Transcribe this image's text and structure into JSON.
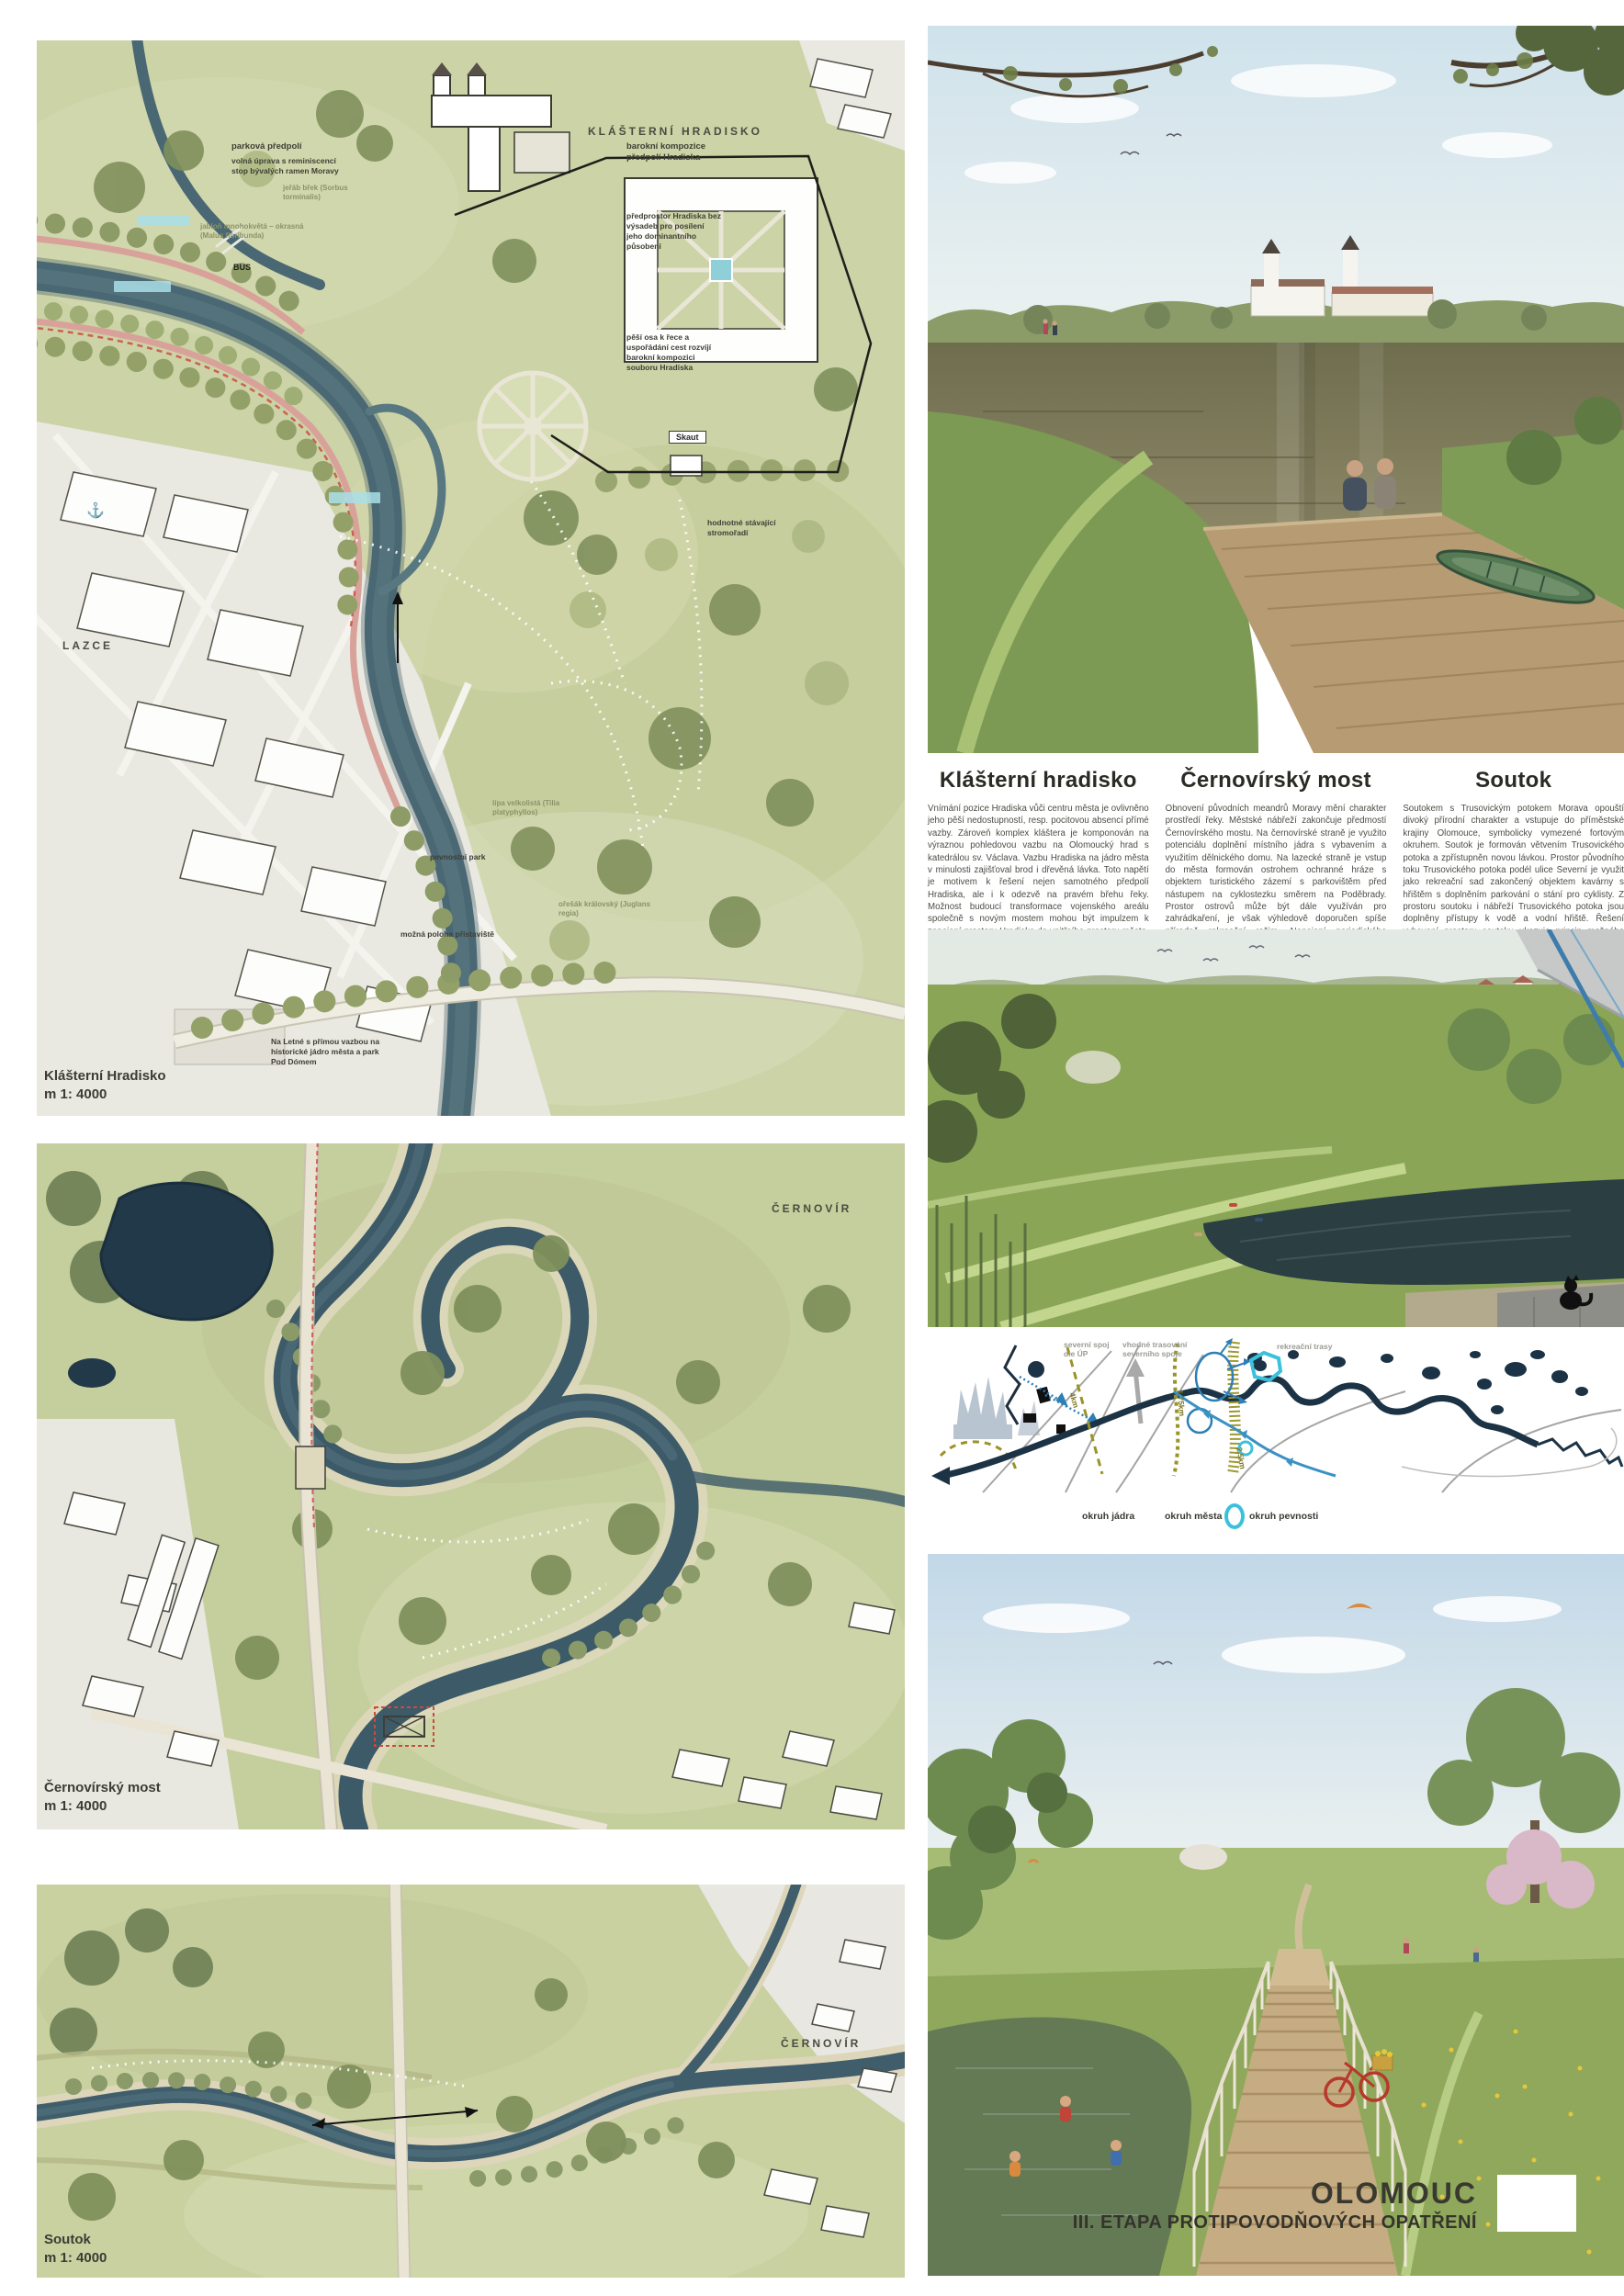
{
  "title_block": {
    "city": "OLOMOUC",
    "subtitle": "III. ETAPA PROTIPOVODŇOVÝCH OPATŘENÍ"
  },
  "articles": [
    {
      "heading": "Klášterní hradisko",
      "body": "Vnímání pozice Hradiska vůči centru města je ovlivněno jeho pěší nedostupností, resp. pocitovou absencí přímé vazby. Zároveň komplex kláštera je komponován na výraznou pohledovou vazbu na Olomoucký hrad s katedrálou sv. Václava. Vazbu Hradiska na jádro města v minulosti zajišťoval brod i dřevěná lávka. Toto napětí je motivem k řešení nejen samotného předpolí Hradiska, ale i k odezvě na pravém břehu řeky. Možnost budoucí transformace vojenského areálu společně s novým mostem mohou být impulzem k zapojení prostoru Hradiska do vnitřního prostoru města. Předpolí Hradiska přibližuje k městu nový ostrov na ose kláštera, přístupný brodem. Volné plochy po stranách Hradiska jsou upraveny na povodňový park. Sokolovská je jižně od Hradiska zklidněna pro posílení vazby na nábřeží."
    },
    {
      "heading": "Černovírský most",
      "body": "Obnovení původních meandrů Moravy mění charakter prostředí řeky. Městské nábřeží zakončuje předmostí Černovírského mostu. Na černovírské straně je využito potenciálu doplnění místního jádra s vybavením a využitím dělnického domu. Na lazecké straně je vstup do města formován ostrohem ochranné hráze s objektem turistického zázemí s parkovištěm před nástupem na cyklostezku směrem na Poděbrady. Prostor ostrovů může být dále využíván pro zahrádkaření, je však výhledově doporučen spíše přírodně rekreační režim. Napojení periodického ramene předpokládá rozšíření Černovírského mostu, není však podmínkou úpravy hlavního koryta."
    },
    {
      "heading": "Soutok",
      "body": "Soutokem s Trusovickým potokem Morava opouští divoký přírodní charakter a vstupuje do příměstské krajiny Olomouce, symbolicky vymezené fortovým okruhem. Soutok je formován větvením Trusovického potoka a zpřístupněn novou lávkou. Prostor původního toku Trusovického potoka podél ulice Severní je využit jako rekreační sad zakončený objektem kavárny s hřištěm s doplněním parkování o stání pro cyklisty. Z prostoru soutoku i nábřeží Trusovického potoka jsou doplněny přístupy k vodě a vodní hřiště. Řešení vybavení prostoru soutoku ukazuje princip možného řešení obdobných situací na rekreačních stezkách v krajině."
    }
  ],
  "maps": {
    "hradisko": {
      "caption_title": "Klášterní Hradisko",
      "caption_scale": "m 1: 4000",
      "district_label": "KLÁŠTERNÍ HRADISKO",
      "lazce_label": "LAZCE",
      "annotations": [
        "parková předpolí",
        "volná úprava s reminiscencí stop bývalých ramen Moravy",
        "barokní kompozice předpolí Hradiska",
        "předprostor Hradiska bez výsadeb pro posílení jeho dominantního působení",
        "pěší osa k řece a uspořádání cest rozvíjí barokní kompozici souboru Hradiska",
        "hodnotné stávající stromořadí",
        "pevnostní park",
        "možná poloha přístaviště",
        "Na Letné s přímou vazbou na historické jádro města a park Pod Dómem",
        "Skaut",
        "BUS"
      ],
      "tree_labels": [
        "lípa velkolistá (Tilia platyphyllos)",
        "jeřáb břek (Sorbus torminalis)",
        "jabloň mnohokvětá – okrasná (Malus floribunda)",
        "ořešák královský (Juglans regia)"
      ]
    },
    "cernovir": {
      "caption_title": "Černovírský most",
      "caption_scale": "m 1: 4000",
      "district_label": "ČERNOVÍR"
    },
    "soutok": {
      "caption_title": "Soutok",
      "caption_scale": "m 1: 4000",
      "district_label": "ČERNOVÍR"
    }
  },
  "diagram": {
    "labels": {
      "severni_spoj": "severní spoj dle ÚP",
      "trasovani": "vhodné trasování severního spoje",
      "rekreacni": "rekreační trasy",
      "d4": "4km",
      "d175": "1,75km",
      "d25": "2,5km"
    },
    "legend": [
      {
        "label": "okruh jádra"
      },
      {
        "label": "okruh města"
      },
      {
        "label": "okruh pevnosti"
      }
    ]
  },
  "icons": {
    "anchor": "⚓"
  },
  "colors": {
    "map_water": "#47646f",
    "map_green": "#ccd3a6",
    "diagram_navy": "#1c3346",
    "diagram_olive": "#9a9327",
    "accent_cyan": "#3cc1dc",
    "route_blue": "#3a92c4",
    "title_ink": "#33322b"
  }
}
